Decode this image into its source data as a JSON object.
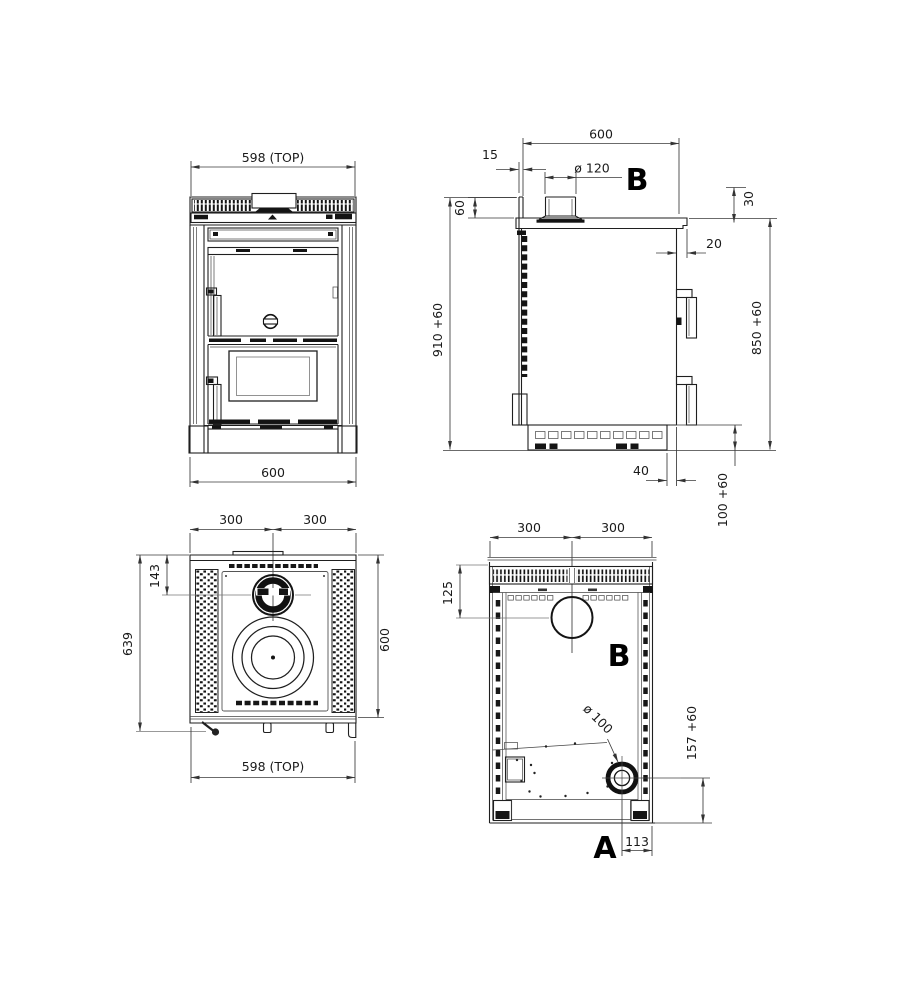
{
  "drawing": {
    "front": {
      "top_width": "598 (TOP)",
      "bottom_width": "600"
    },
    "side": {
      "depth": "600",
      "flue_setback": "15",
      "flue_diameter": "ø 120",
      "flue_label": "B",
      "upstand_height": "60",
      "top_edge": "30",
      "top_overhang": "20",
      "overall_height": "910 +60",
      "worktop_height": "850 +60",
      "base_recess": "40",
      "base_height": "100 +60"
    },
    "top": {
      "half_left": "300",
      "half_right": "300",
      "flue_center": "143",
      "depth_total": "639",
      "depth": "600",
      "top_width": "598 (TOP)"
    },
    "rear": {
      "half_left": "300",
      "half_right": "300",
      "flue_drop": "125",
      "flue_label": "B",
      "intake_diameter": "ø 100",
      "intake_height": "157 +60",
      "intake_label": "A",
      "intake_offset": "113"
    }
  }
}
